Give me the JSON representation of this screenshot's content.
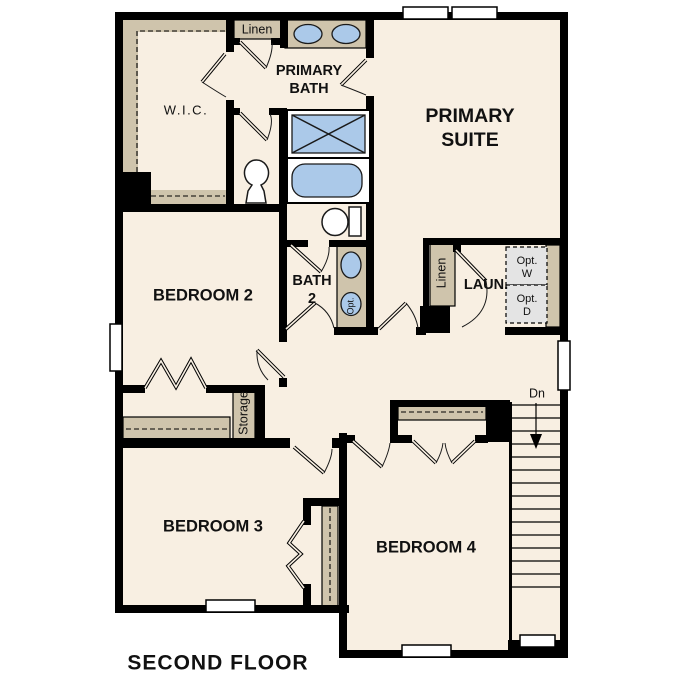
{
  "title": "SECOND FLOOR",
  "colors": {
    "background": "#ffffff",
    "floor": "#f8efe2",
    "walls": "#000000",
    "cabinetry": "#cfc4ac",
    "fixtures": "#abc9e9",
    "optional_appliance_box": "#e4e4e4",
    "text": "#111111"
  },
  "rooms": {
    "wic": "W.I.C.",
    "primary_bath": [
      "PRIMARY",
      "BATH"
    ],
    "primary_suite": [
      "PRIMARY",
      "SUITE"
    ],
    "bedroom2": "BEDROOM 2",
    "bath2": [
      "BATH",
      "2"
    ],
    "laundry": "LAUN.",
    "bedroom3": "BEDROOM 3",
    "bedroom4": "BEDROOM 4"
  },
  "closets": {
    "linen_top": "Linen",
    "linen_laundry": "Linen",
    "storage": "Storage"
  },
  "annotations": {
    "stairs_down": "Dn",
    "optional_washer": [
      "Opt.",
      "W"
    ],
    "optional_dryer": [
      "Opt.",
      "D"
    ],
    "optional_sink": "Opt."
  }
}
